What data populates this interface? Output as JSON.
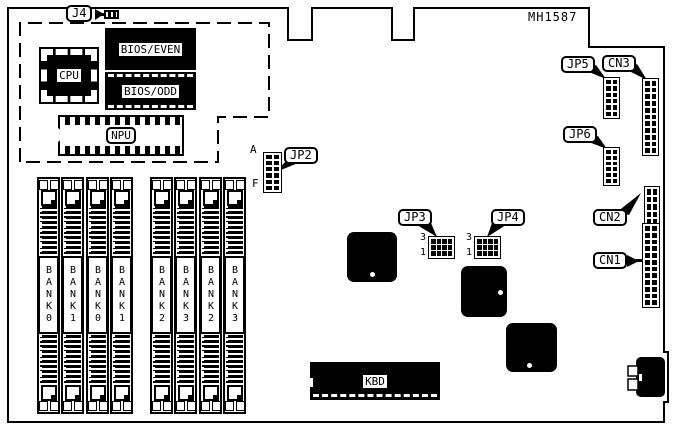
{
  "board": {
    "id": "MH1587"
  },
  "callouts": {
    "j4": "J4",
    "jp2": "JP2",
    "jp3": "JP3",
    "jp4": "JP4",
    "jp5": "JP5",
    "jp6": "JP6",
    "cn1": "CN1",
    "cn2": "CN2",
    "cn3": "CN3"
  },
  "chips": {
    "cpu": "CPU",
    "bios_even": "BIOS/EVEN",
    "bios_odd": "BIOS/ODD",
    "npu": "NPU",
    "kbd": "KBD"
  },
  "banks": [
    {
      "label": "BANK0"
    },
    {
      "label": "BANK1"
    },
    {
      "label": "BANK0"
    },
    {
      "label": "BANK1"
    },
    {
      "label": "BANK2"
    },
    {
      "label": "BANK3"
    },
    {
      "label": "BANK2"
    },
    {
      "label": "BANK3"
    }
  ],
  "pin_labels": {
    "jp2_top": "A",
    "jp2_bottom": "F",
    "jp3_top": "3",
    "jp3_bottom": "1",
    "jp4_top": "3",
    "jp4_bottom": "1"
  }
}
